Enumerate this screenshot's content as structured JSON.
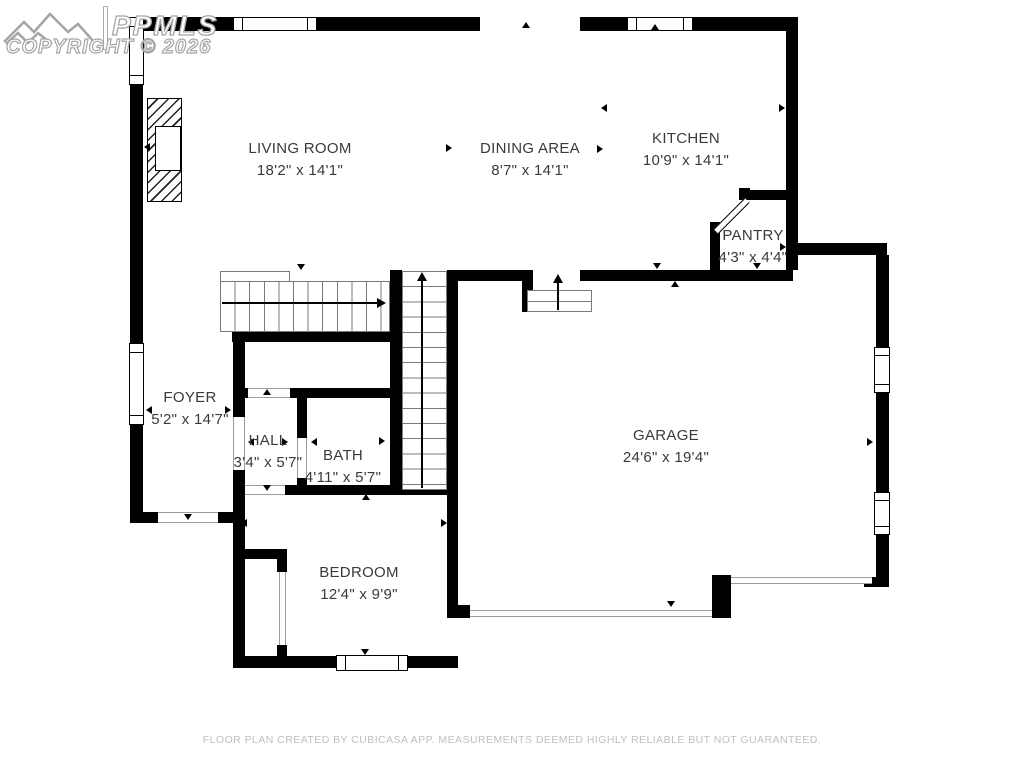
{
  "watermark": {
    "brand": "PPMLS",
    "copyright": "COPYRIGHT © 2026"
  },
  "rooms": [
    {
      "name": "LIVING ROOM",
      "dims": "18'2\" x 14'1\""
    },
    {
      "name": "DINING AREA",
      "dims": "8'7\" x 14'1\""
    },
    {
      "name": "KITCHEN",
      "dims": "10'9\" x 14'1\""
    },
    {
      "name": "PANTRY",
      "dims": "4'3\" x 4'4\""
    },
    {
      "name": "FOYER",
      "dims": "5'2\" x 14'7\""
    },
    {
      "name": "HALL",
      "dims": "3'4\" x 5'7\""
    },
    {
      "name": "BATH",
      "dims": "4'11\" x 5'7\""
    },
    {
      "name": "GARAGE",
      "dims": "24'6\" x 19'4\""
    },
    {
      "name": "BEDROOM",
      "dims": "12'4\" x 9'9\""
    }
  ],
  "footer": {
    "disclaimer": "FLOOR PLAN CREATED BY CUBICASA APP. MEASUREMENTS DEEMED HIGHLY RELIABLE BUT NOT GUARANTEED."
  },
  "colors": {
    "wall": "#000000",
    "label": "#3a3a3a",
    "footer_text": "#bfbfbf",
    "watermark_outline": "#a5a5a5"
  }
}
